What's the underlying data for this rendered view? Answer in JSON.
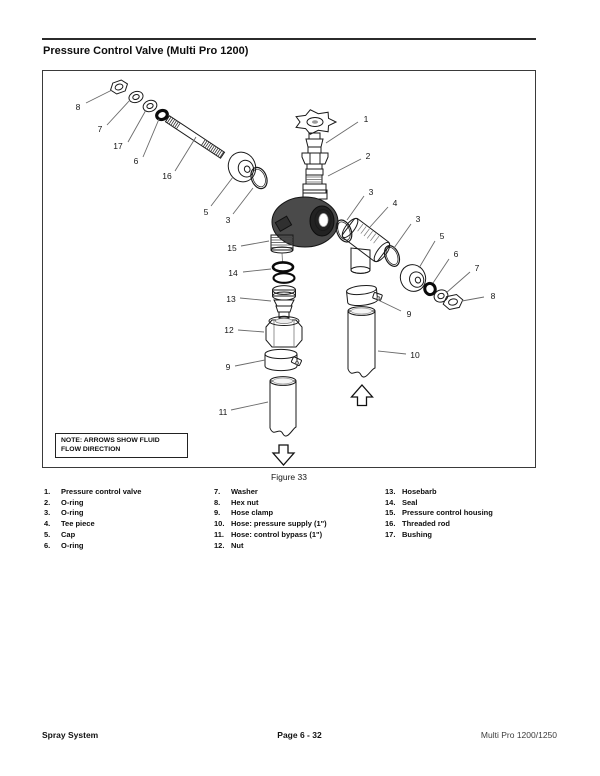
{
  "header": {
    "title": "Pressure Control Valve (Multi Pro 1200)"
  },
  "diagram": {
    "note_line1": "NOTE: ARROWS SHOW FLUID",
    "note_line2": "FLOW DIRECTION",
    "caption": "Figure 33",
    "arrow_meaning": "fluid flow direction",
    "callouts": [
      {
        "n": "8",
        "lx": 78,
        "ly": 107,
        "x1": 86,
        "y1": 103,
        "x2": 112,
        "y2": 90
      },
      {
        "n": "7",
        "lx": 100,
        "ly": 129,
        "x1": 107,
        "y1": 125,
        "x2": 130,
        "y2": 100
      },
      {
        "n": "17",
        "lx": 118,
        "ly": 146,
        "x1": 128,
        "y1": 142,
        "x2": 146,
        "y2": 110
      },
      {
        "n": "6",
        "lx": 136,
        "ly": 161,
        "x1": 143,
        "y1": 157,
        "x2": 159,
        "y2": 119
      },
      {
        "n": "16",
        "lx": 167,
        "ly": 176,
        "x1": 175,
        "y1": 171,
        "x2": 196,
        "y2": 137
      },
      {
        "n": "5",
        "lx": 206,
        "ly": 212,
        "x1": 211,
        "y1": 206,
        "x2": 233,
        "y2": 177
      },
      {
        "n": "3",
        "lx": 228,
        "ly": 220,
        "x1": 233,
        "y1": 214,
        "x2": 253,
        "y2": 188
      },
      {
        "n": "15",
        "lx": 232,
        "ly": 248,
        "x1": 241,
        "y1": 246,
        "x2": 269,
        "y2": 241
      },
      {
        "n": "14",
        "lx": 233,
        "ly": 273,
        "x1": 243,
        "y1": 272,
        "x2": 271,
        "y2": 269
      },
      {
        "n": "13",
        "lx": 231,
        "ly": 299,
        "x1": 240,
        "y1": 298,
        "x2": 271,
        "y2": 301
      },
      {
        "n": "12",
        "lx": 229,
        "ly": 330,
        "x1": 238,
        "y1": 330,
        "x2": 264,
        "y2": 332
      },
      {
        "n": "9",
        "lx": 228,
        "ly": 367,
        "x1": 235,
        "y1": 366,
        "x2": 265,
        "y2": 360
      },
      {
        "n": "11",
        "lx": 223,
        "ly": 412,
        "x1": 231,
        "y1": 410,
        "x2": 268,
        "y2": 402
      },
      {
        "n": "1",
        "lx": 366,
        "ly": 119,
        "x1": 358,
        "y1": 122,
        "x2": 326,
        "y2": 143
      },
      {
        "n": "2",
        "lx": 368,
        "ly": 156,
        "x1": 361,
        "y1": 159,
        "x2": 328,
        "y2": 176
      },
      {
        "n": "3",
        "lx": 371,
        "ly": 192,
        "x1": 364,
        "y1": 196,
        "x2": 347,
        "y2": 220
      },
      {
        "n": "4",
        "lx": 395,
        "ly": 203,
        "x1": 388,
        "y1": 207,
        "x2": 370,
        "y2": 227
      },
      {
        "n": "3",
        "lx": 418,
        "ly": 219,
        "x1": 411,
        "y1": 224,
        "x2": 394,
        "y2": 248
      },
      {
        "n": "5",
        "lx": 442,
        "ly": 236,
        "x1": 435,
        "y1": 241,
        "x2": 419,
        "y2": 268
      },
      {
        "n": "6",
        "lx": 456,
        "ly": 254,
        "x1": 449,
        "y1": 259,
        "x2": 433,
        "y2": 283
      },
      {
        "n": "7",
        "lx": 477,
        "ly": 268,
        "x1": 470,
        "y1": 272,
        "x2": 446,
        "y2": 293
      },
      {
        "n": "8",
        "lx": 493,
        "ly": 296,
        "x1": 484,
        "y1": 297,
        "x2": 462,
        "y2": 301
      },
      {
        "n": "9",
        "lx": 409,
        "ly": 314,
        "x1": 401,
        "y1": 311,
        "x2": 378,
        "y2": 300
      },
      {
        "n": "10",
        "lx": 415,
        "ly": 355,
        "x1": 406,
        "y1": 354,
        "x2": 378,
        "y2": 351
      }
    ]
  },
  "parts_list": {
    "columns": [
      [
        {
          "num": "1.",
          "label": "Pressure control valve"
        },
        {
          "num": "2.",
          "label": "O-ring"
        },
        {
          "num": "3.",
          "label": "O-ring"
        },
        {
          "num": "4.",
          "label": "Tee piece"
        },
        {
          "num": "5.",
          "label": "Cap"
        },
        {
          "num": "6.",
          "label": "O-ring"
        }
      ],
      [
        {
          "num": "7.",
          "label": "Washer"
        },
        {
          "num": "8.",
          "label": "Hex nut"
        },
        {
          "num": "9.",
          "label": "Hose clamp"
        },
        {
          "num": "10.",
          "label": "Hose: pressure supply (1\")"
        },
        {
          "num": "11.",
          "label": "Hose: control bypass (1\")"
        },
        {
          "num": "12.",
          "label": "Nut"
        }
      ],
      [
        {
          "num": "13.",
          "label": "Hosebarb"
        },
        {
          "num": "14.",
          "label": "Seal"
        },
        {
          "num": "15.",
          "label": "Pressure control housing"
        },
        {
          "num": "16.",
          "label": "Threaded rod"
        },
        {
          "num": "17.",
          "label": "Bushing"
        }
      ]
    ]
  },
  "footer": {
    "left": "Spray System",
    "center": "Page 6 - 32",
    "right": "Multi Pro 1200/1250"
  }
}
